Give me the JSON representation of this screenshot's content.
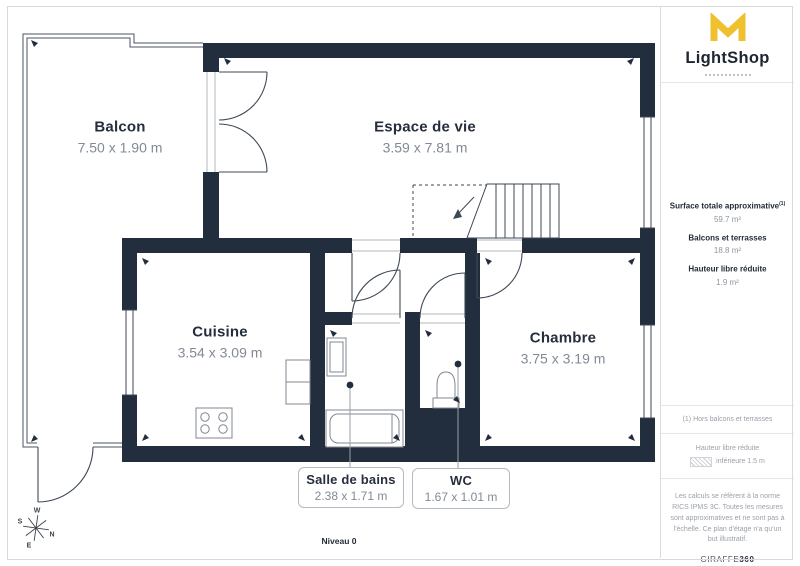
{
  "branding": {
    "logo_text": "LightShop",
    "accent_color": "#EFC12F"
  },
  "rooms": [
    {
      "id": "balcon",
      "name": "Balcon",
      "dimensions": "7.50 x 1.90 m"
    },
    {
      "id": "espace",
      "name": "Espace de vie",
      "dimensions": "3.59 x 7.81 m"
    },
    {
      "id": "cuisine",
      "name": "Cuisine",
      "dimensions": "3.54 x 3.09 m"
    },
    {
      "id": "chambre",
      "name": "Chambre",
      "dimensions": "3.75 x 3.19 m"
    }
  ],
  "callouts": [
    {
      "id": "salle-de-bains",
      "name": "Salle de bains",
      "dimensions": "2.38 x 1.71 m"
    },
    {
      "id": "wc",
      "name": "WC",
      "dimensions": "1.67 x 1.01 m"
    }
  ],
  "level_label": "Niveau 0",
  "compass": {
    "n": "N",
    "s": "S",
    "e": "E",
    "w": "W"
  },
  "sidebar": {
    "measurements": [
      {
        "label": "Surface totale approximative",
        "sup": "(1)",
        "value": "59.7 m²"
      },
      {
        "label": "Balcons et terrasses",
        "sup": "",
        "value": "18.8 m²"
      },
      {
        "label": "Hauteur libre réduite",
        "sup": "",
        "value": "1.9 m²"
      }
    ],
    "footnote": "(1) Hors balcons et terrasses",
    "legend": {
      "title": "Hauteur libre réduite",
      "item": "inférieure 1.5 m"
    },
    "disclaimer": "Les calculs se réfèrent à la norme RICS IPMS 3C. Toutes les mesures sont approximatives et ne sont pas à l'échelle. Ce plan d'étage n'a qu'un but illustratif.",
    "brand": "GIRAFFE",
    "brand_suffix": "360"
  },
  "colors": {
    "wall": "#222d3d",
    "thin_line": "#3f4956"
  }
}
